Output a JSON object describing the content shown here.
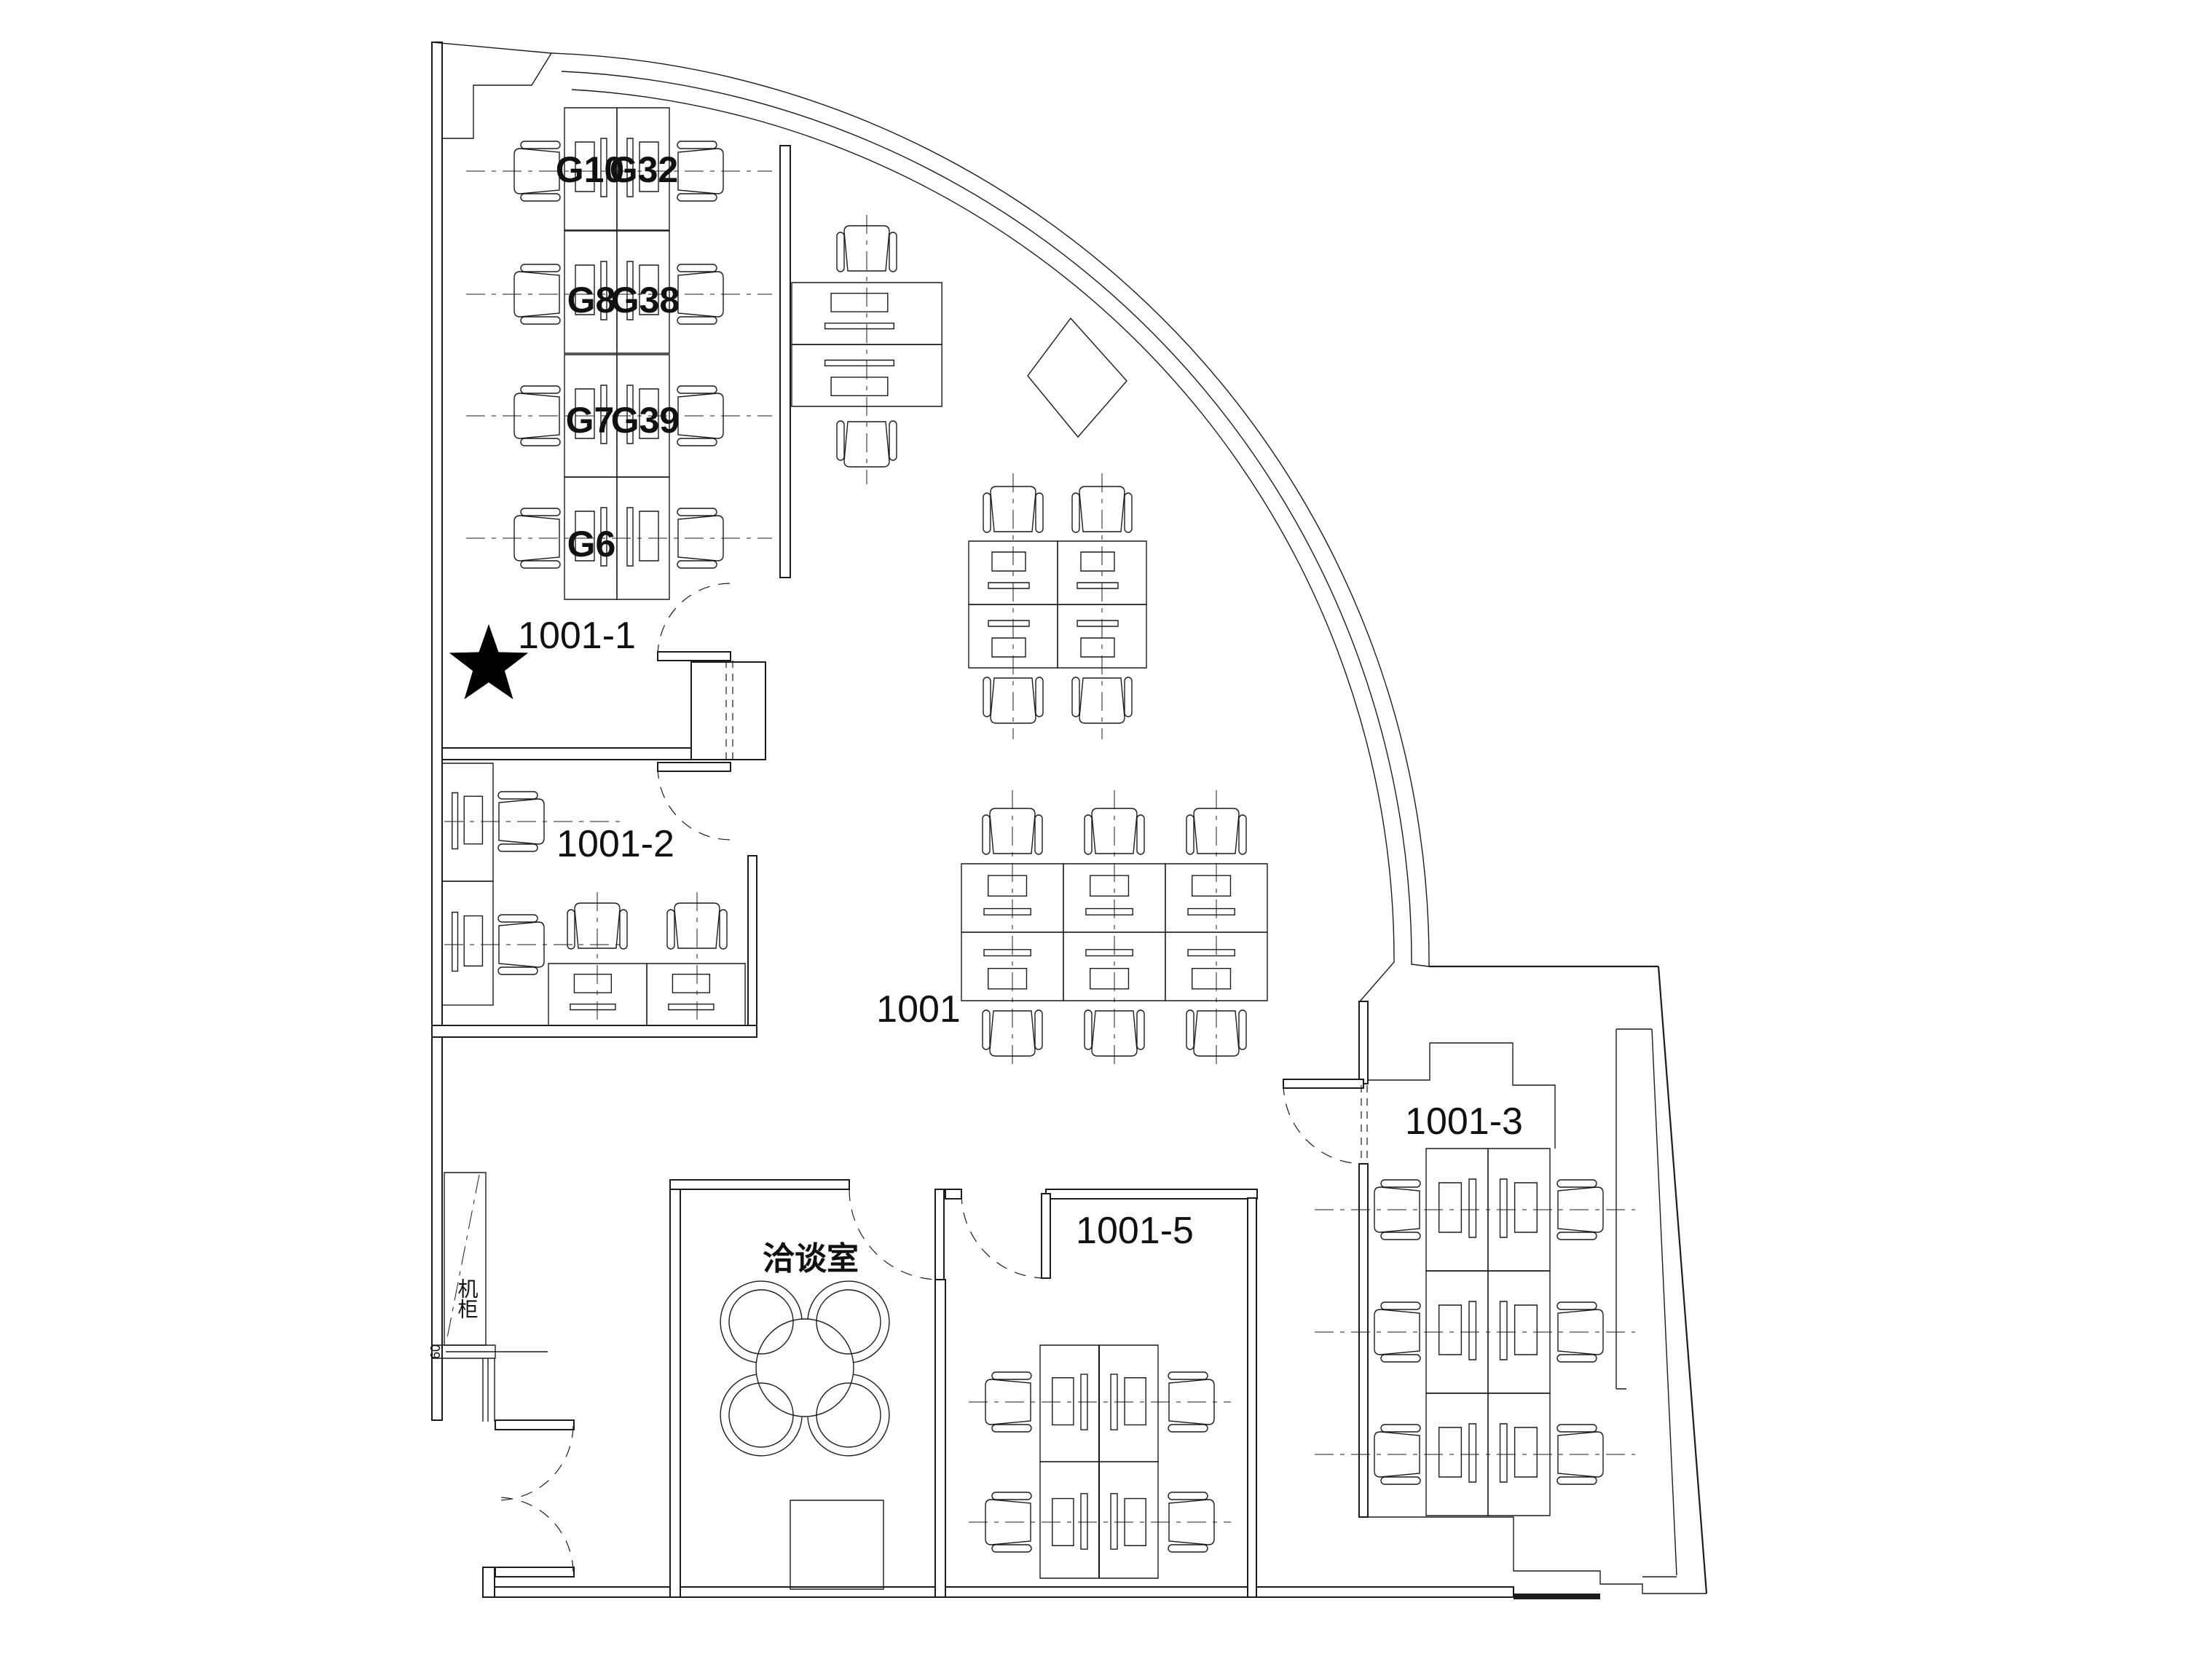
{
  "floorplan": {
    "rooms": {
      "r1001_1": "1001-1",
      "r1001_2": "1001-2",
      "r1001": "1001",
      "r1001_3": "1001-3",
      "r1001_5": "1001-5",
      "meeting": "洽谈室",
      "cabinet": "机柜"
    },
    "workstations": {
      "g10": "G10",
      "g32": "G32",
      "g8": "G8",
      "g38": "G38",
      "g7": "G7",
      "g39": "G39",
      "g6": "G6"
    },
    "dimension": "60",
    "marker": {
      "shape": "star",
      "location_room": "1001-1",
      "color": "#000000"
    },
    "colors": {
      "line": "#1c1c1c",
      "background": "#ffffff"
    }
  }
}
